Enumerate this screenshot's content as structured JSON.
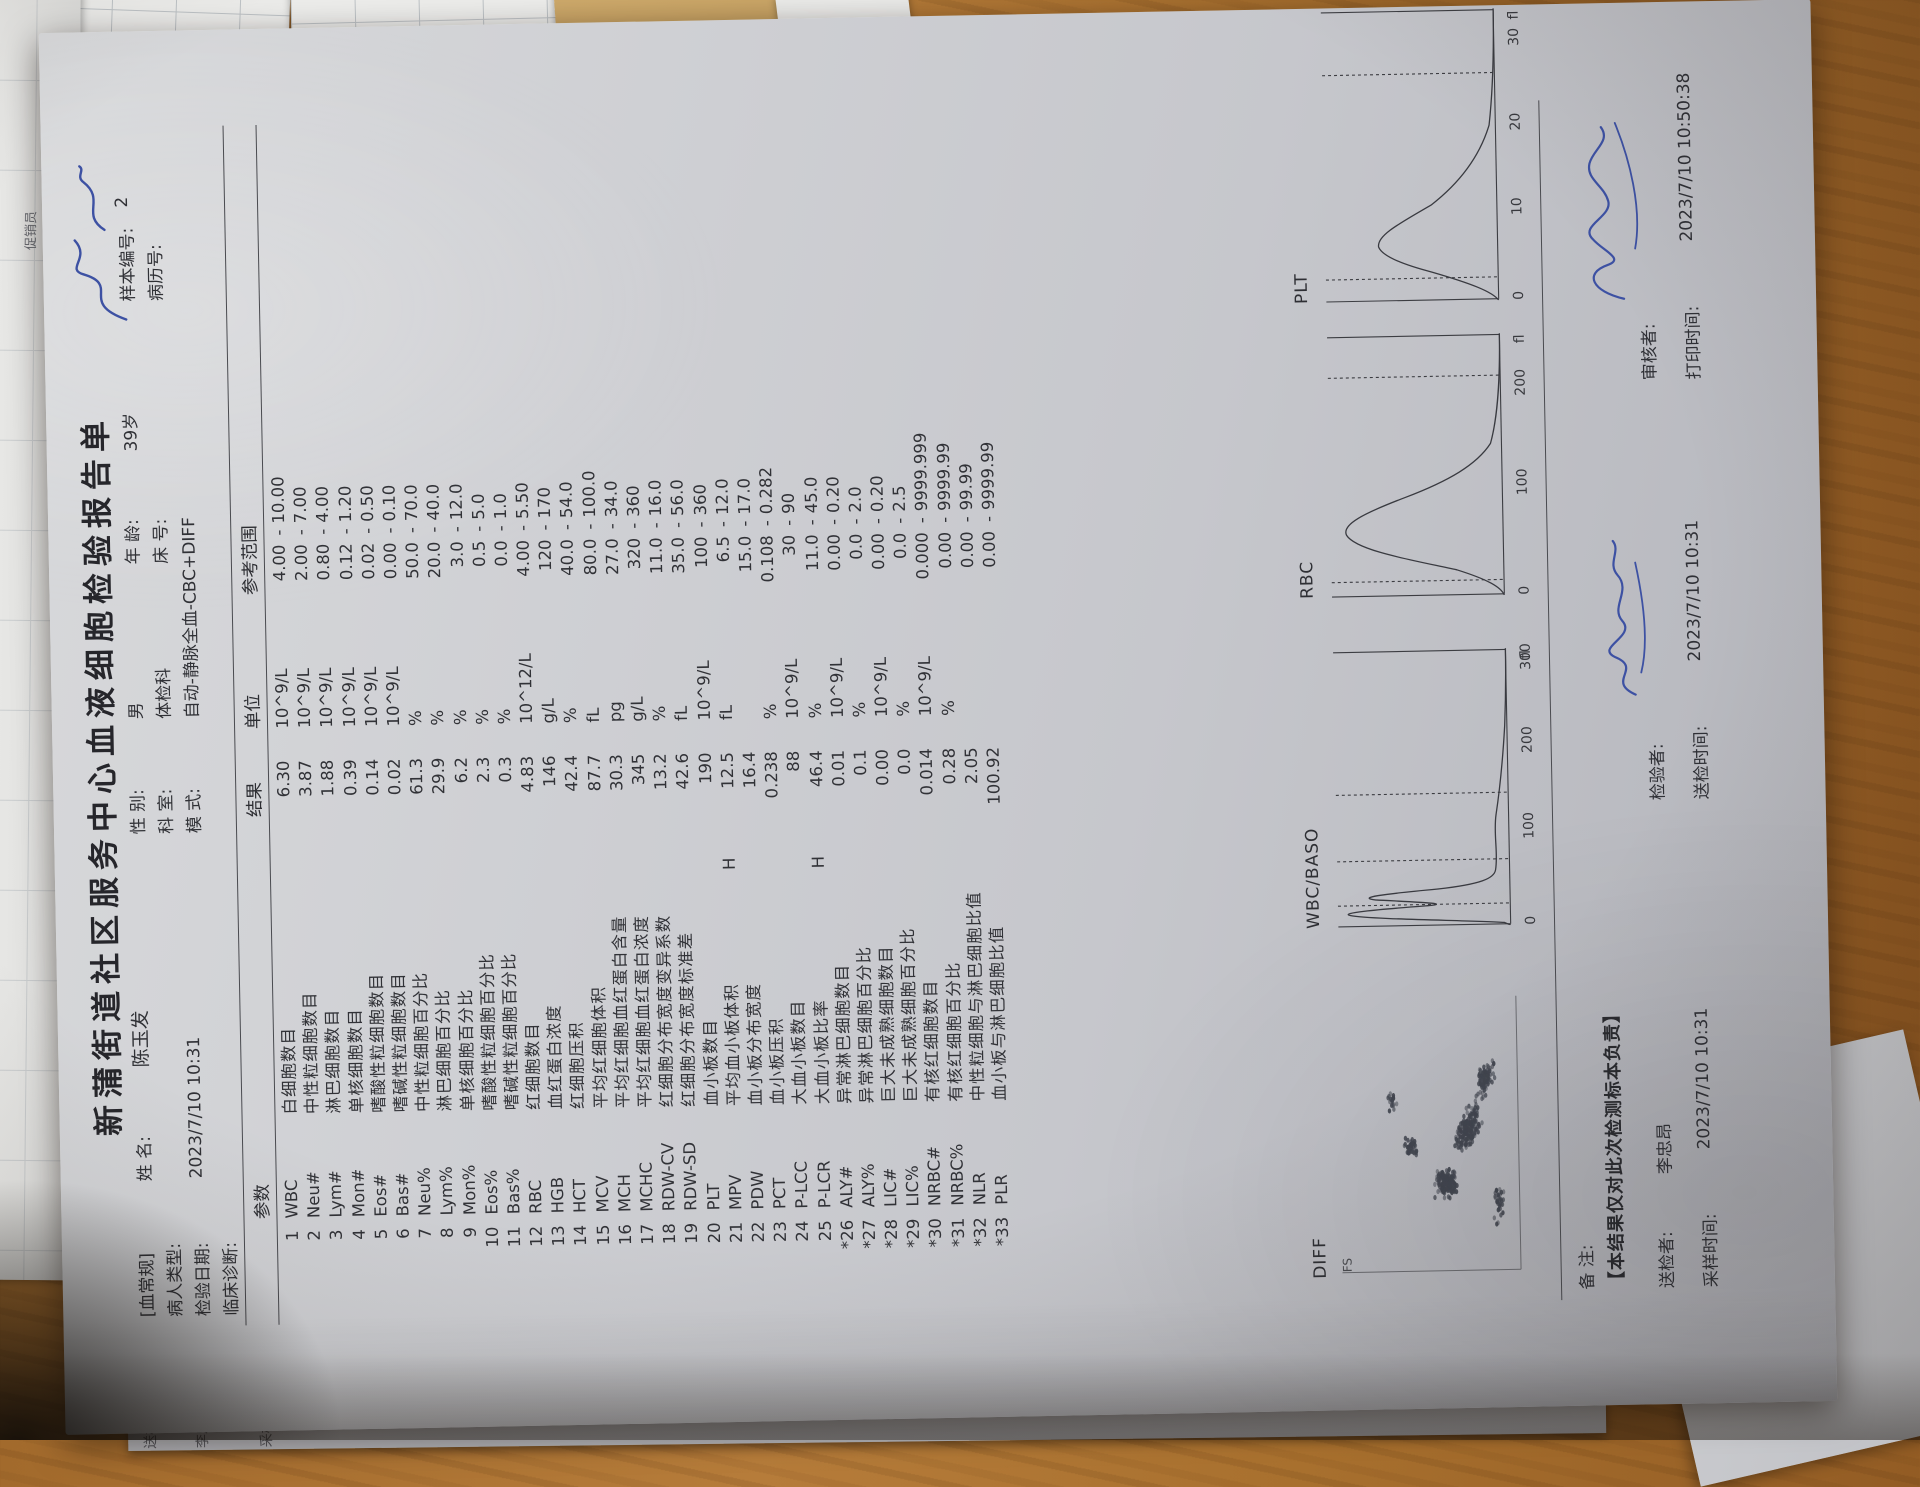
{
  "report": {
    "title": "新蒲街道社区服务中心血液细胞检验报告单",
    "header": {
      "blood_routine_tag": "[血常规]",
      "name_label": "姓  名:",
      "name": "陈玉发",
      "sex_label": "性  别:",
      "sex": "男",
      "age_label": "年  龄:",
      "age": "39岁",
      "sample_no_label": "样本编号:",
      "sample_no": "2",
      "patient_type_label": "病人类型:",
      "dept_label": "科  室:",
      "dept": "体检科",
      "bed_label": "床  号:",
      "record_no_label": "病历号:",
      "test_date_label": "检验日期:",
      "test_date": "2023/7/10  10:31",
      "mode_label": "模  式:",
      "mode": "自动-静脉全血-CBC+DIFF",
      "diagnosis_label": "临床诊断:"
    },
    "table": {
      "col_param": "参数",
      "col_result": "结果",
      "col_unit": "单位",
      "col_ref": "参考范围",
      "rows": [
        {
          "idx": "1",
          "abbr": "WBC",
          "name": "白细胞数目",
          "flag": "",
          "result": "6.30",
          "unit": "10^9/L",
          "lo": "4.00",
          "hi": "10.00"
        },
        {
          "idx": "2",
          "abbr": "Neu#",
          "name": "中性粒细胞数目",
          "flag": "",
          "result": "3.87",
          "unit": "10^9/L",
          "lo": "2.00",
          "hi": "7.00"
        },
        {
          "idx": "3",
          "abbr": "Lym#",
          "name": "淋巴细胞数目",
          "flag": "",
          "result": "1.88",
          "unit": "10^9/L",
          "lo": "0.80",
          "hi": "4.00"
        },
        {
          "idx": "4",
          "abbr": "Mon#",
          "name": "单核细胞数目",
          "flag": "",
          "result": "0.39",
          "unit": "10^9/L",
          "lo": "0.12",
          "hi": "1.20"
        },
        {
          "idx": "5",
          "abbr": "Eos#",
          "name": "嗜酸性粒细胞数目",
          "flag": "",
          "result": "0.14",
          "unit": "10^9/L",
          "lo": "0.02",
          "hi": "0.50"
        },
        {
          "idx": "6",
          "abbr": "Bas#",
          "name": "嗜碱性粒细胞数目",
          "flag": "",
          "result": "0.02",
          "unit": "10^9/L",
          "lo": "0.00",
          "hi": "0.10"
        },
        {
          "idx": "7",
          "abbr": "Neu%",
          "name": "中性粒细胞百分比",
          "flag": "",
          "result": "61.3",
          "unit": "%",
          "lo": "50.0",
          "hi": "70.0"
        },
        {
          "idx": "8",
          "abbr": "Lym%",
          "name": "淋巴细胞百分比",
          "flag": "",
          "result": "29.9",
          "unit": "%",
          "lo": "20.0",
          "hi": "40.0"
        },
        {
          "idx": "9",
          "abbr": "Mon%",
          "name": "单核细胞百分比",
          "flag": "",
          "result": "6.2",
          "unit": "%",
          "lo": "3.0",
          "hi": "12.0"
        },
        {
          "idx": "10",
          "abbr": "Eos%",
          "name": "嗜酸性粒细胞百分比",
          "flag": "",
          "result": "2.3",
          "unit": "%",
          "lo": "0.5",
          "hi": "5.0"
        },
        {
          "idx": "11",
          "abbr": "Bas%",
          "name": "嗜碱性粒细胞百分比",
          "flag": "",
          "result": "0.3",
          "unit": "%",
          "lo": "0.0",
          "hi": "1.0"
        },
        {
          "idx": "12",
          "abbr": "RBC",
          "name": "红细胞数目",
          "flag": "",
          "result": "4.83",
          "unit": "10^12/L",
          "lo": "4.00",
          "hi": "5.50"
        },
        {
          "idx": "13",
          "abbr": "HGB",
          "name": "血红蛋白浓度",
          "flag": "",
          "result": "146",
          "unit": "g/L",
          "lo": "120",
          "hi": "170"
        },
        {
          "idx": "14",
          "abbr": "HCT",
          "name": "红细胞压积",
          "flag": "",
          "result": "42.4",
          "unit": "%",
          "lo": "40.0",
          "hi": "54.0"
        },
        {
          "idx": "15",
          "abbr": "MCV",
          "name": "平均红细胞体积",
          "flag": "",
          "result": "87.7",
          "unit": "fL",
          "lo": "80.0",
          "hi": "100.0"
        },
        {
          "idx": "16",
          "abbr": "MCH",
          "name": "平均红细胞血红蛋白含量",
          "flag": "",
          "result": "30.3",
          "unit": "pg",
          "lo": "27.0",
          "hi": "34.0"
        },
        {
          "idx": "17",
          "abbr": "MCHC",
          "name": "平均红细胞血红蛋白浓度",
          "flag": "",
          "result": "345",
          "unit": "g/L",
          "lo": "320",
          "hi": "360"
        },
        {
          "idx": "18",
          "abbr": "RDW-CV",
          "name": "红细胞分布宽度变异系数",
          "flag": "",
          "result": "13.2",
          "unit": "%",
          "lo": "11.0",
          "hi": "16.0"
        },
        {
          "idx": "19",
          "abbr": "RDW-SD",
          "name": "红细胞分布宽度标准差",
          "flag": "",
          "result": "42.6",
          "unit": "fL",
          "lo": "35.0",
          "hi": "56.0"
        },
        {
          "idx": "20",
          "abbr": "PLT",
          "name": "血小板数目",
          "flag": "",
          "result": "190",
          "unit": "10^9/L",
          "lo": "100",
          "hi": "360"
        },
        {
          "idx": "21",
          "abbr": "MPV",
          "name": "平均血小板体积",
          "flag": "H",
          "result": "12.5",
          "unit": "fL",
          "lo": "6.5",
          "hi": "12.0"
        },
        {
          "idx": "22",
          "abbr": "PDW",
          "name": "血小板分布宽度",
          "flag": "",
          "result": "16.4",
          "unit": "",
          "lo": "15.0",
          "hi": "17.0"
        },
        {
          "idx": "23",
          "abbr": "PCT",
          "name": "血小板压积",
          "flag": "",
          "result": "0.238",
          "unit": "%",
          "lo": "0.108",
          "hi": "0.282"
        },
        {
          "idx": "24",
          "abbr": "P-LCC",
          "name": "大血小板数目",
          "flag": "",
          "result": "88",
          "unit": "10^9/L",
          "lo": "30",
          "hi": "90"
        },
        {
          "idx": "25",
          "abbr": "P-LCR",
          "name": "大血小板比率",
          "flag": "H",
          "result": "46.4",
          "unit": "%",
          "lo": "11.0",
          "hi": "45.0"
        },
        {
          "idx": "*26",
          "abbr": "ALY#",
          "name": "异常淋巴细胞数目",
          "flag": "",
          "result": "0.01",
          "unit": "10^9/L",
          "lo": "0.00",
          "hi": "0.20"
        },
        {
          "idx": "*27",
          "abbr": "ALY%",
          "name": "异常淋巴细胞百分比",
          "flag": "",
          "result": "0.1",
          "unit": "%",
          "lo": "0.0",
          "hi": "2.0"
        },
        {
          "idx": "*28",
          "abbr": "LIC#",
          "name": "巨大未成熟细胞数目",
          "flag": "",
          "result": "0.00",
          "unit": "10^9/L",
          "lo": "0.00",
          "hi": "0.20"
        },
        {
          "idx": "*29",
          "abbr": "LIC%",
          "name": "巨大未成熟细胞百分比",
          "flag": "",
          "result": "0.0",
          "unit": "%",
          "lo": "0.0",
          "hi": "2.5"
        },
        {
          "idx": "*30",
          "abbr": "NRBC#",
          "name": "有核红细胞数目",
          "flag": "",
          "result": "0.014",
          "unit": "10^9/L",
          "lo": "0.000",
          "hi": "9999.999"
        },
        {
          "idx": "*31",
          "abbr": "NRBC%",
          "name": "有核红细胞百分比",
          "flag": "",
          "result": "0.28",
          "unit": "%",
          "lo": "0.00",
          "hi": "9999.99"
        },
        {
          "idx": "*32",
          "abbr": "NLR",
          "name": "中性粒细胞与淋巴细胞比值",
          "flag": "",
          "result": "2.05",
          "unit": "",
          "lo": "0.00",
          "hi": "99.99"
        },
        {
          "idx": "*33",
          "abbr": "PLR",
          "name": "血小板与淋巴细胞比值",
          "flag": "",
          "result": "100.92",
          "unit": "",
          "lo": "0.00",
          "hi": "9999.99"
        }
      ]
    },
    "charts": {
      "diff": {
        "label": "DIFF",
        "axis_label": "FS",
        "clusters": [
          {
            "cx": 33,
            "cy": 58,
            "sx": 6,
            "sy": 7,
            "n": 150,
            "tilt": 0
          },
          {
            "cx": 52,
            "cy": 70,
            "sx": 12,
            "sy": 6,
            "n": 190,
            "tilt": 35
          },
          {
            "cx": 46,
            "cy": 40,
            "sx": 4,
            "sy": 5,
            "n": 40,
            "tilt": 0
          },
          {
            "cx": 70,
            "cy": 80,
            "sx": 9,
            "sy": 5,
            "n": 90,
            "tilt": 20
          },
          {
            "cx": 25,
            "cy": 86,
            "sx": 10,
            "sy": 4,
            "n": 35,
            "tilt": 0
          },
          {
            "cx": 62,
            "cy": 30,
            "sx": 5,
            "sy": 4,
            "n": 18,
            "tilt": 0
          }
        ]
      },
      "wbc": {
        "label": "WBC/BASO",
        "dashes": [
          8,
          24,
          48
        ],
        "ticks": [
          "0",
          "100",
          "200",
          "300"
        ],
        "tick_pos": [
          0,
          31,
          62,
          92
        ],
        "unit": "fl",
        "path": "M0,57 L1,55 C2,44 3,12 4.5,6 C5.5,2 6.5,14 7.5,30 C8.2,40 9,26 10,14 C11,8 12,16 13.5,34 C15,48 17,52 20,52.5 C26,53.5 33,52 40,53 C50,54.5 60,55.5 72,56.3 C82,56.8 92,57 100,57"
      },
      "rbc": {
        "label": "RBC",
        "dashes": [
          6,
          84
        ],
        "ticks": [
          "0",
          "100",
          "200"
        ],
        "tick_pos": [
          0,
          38,
          76
        ],
        "unit": "fl",
        "path": "M0,57 C3,56 6,52 10,42 C14,28 18,10 24,7 C28,5.5 32,12 38,26 C44,40 50,49 58,53.5 C68,56 84,57 100,57"
      },
      "plt": {
        "label": "PLT",
        "dashes": [
          8,
          78
        ],
        "ticks": [
          "0",
          "10",
          "20",
          "30"
        ],
        "tick_pos": [
          0,
          29,
          58,
          87
        ],
        "unit": "fl",
        "path": "M0,57 C3,55 6,48 10,36 C13,26 16,20 19,19 C23,18.5 27,26 33,36 C41,46 50,52 60,55 C75,56.8 90,57 100,57"
      }
    },
    "footer": {
      "remark_label": "备 注:",
      "disclaimer": "【本结果仅对此次检测标本负责】",
      "sender_label": "送检者:",
      "sender": "李忠昂",
      "tester_label": "检验者:",
      "reviewer_label": "审核者:",
      "sample_time_label": "采样时间:",
      "sample_time": "2023/7/10  10:31",
      "send_time_label": "送检时间:",
      "send_time": "2023/7/10  10:31",
      "print_time_label": "打印时间:",
      "print_time": "2023/7/10  10:50:38"
    },
    "ink_color": "#3d51a3",
    "print_color": "#33343a"
  },
  "background": {
    "desk_paper_texts": [
      "日化促销员",
      "日化促销员",
      "化促销员",
      "促销员",
      "张华",
      "鲁景玉",
      "余"
    ],
    "page2_edge_texts": [
      "送检者:",
      "李忠昂",
      "采样时间: 2023/7/10 10:31"
    ]
  }
}
